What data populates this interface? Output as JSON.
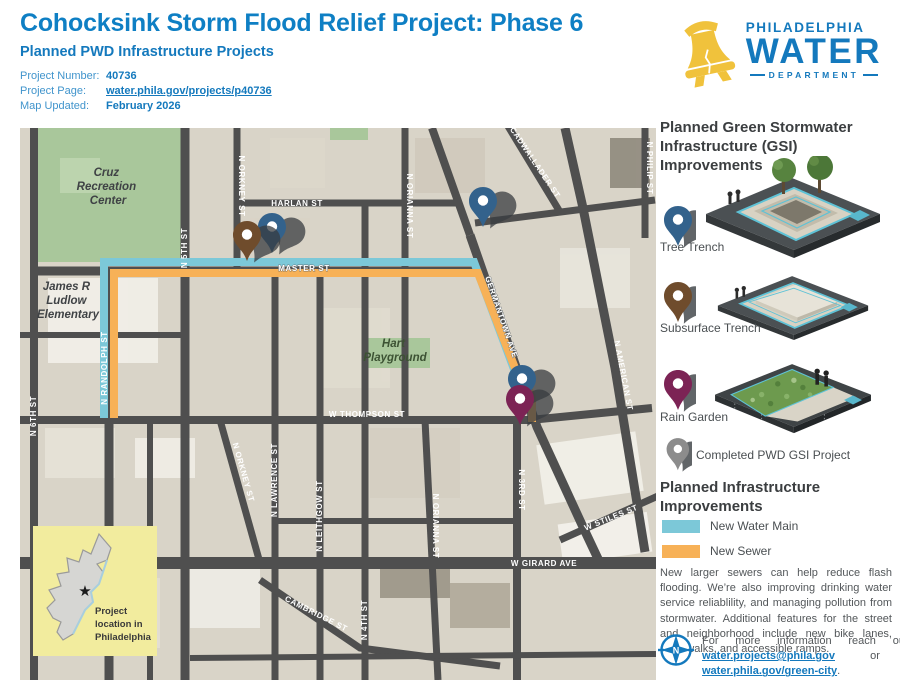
{
  "header": {
    "title": "Cohocksink Storm Flood Relief Project: Phase 6",
    "subtitle": "Planned PWD Infrastructure Projects",
    "info": {
      "project_number_label": "Project Number:",
      "project_number": "40736",
      "project_page_label": "Project Page:",
      "project_page": "water.phila.gov/projects/p40736",
      "map_updated_label": "Map Updated:",
      "map_updated": "February 2026"
    }
  },
  "logo": {
    "line1": "PHILADELPHIA",
    "line2": "WATER",
    "line3": "DEPARTMENT"
  },
  "colors": {
    "pwd_blue": "#1479bd",
    "title_blue": "#0e7fc4",
    "water_main": "#7cc8d8",
    "sewer": "#f7b157",
    "tree_trench_pin": "#33628c",
    "subsurface_pin": "#6f4c2c",
    "rain_garden_pin": "#7c2355",
    "completed_pin": "#8c8c8c",
    "bell_yellow": "#f0c23c"
  },
  "sidebar": {
    "gsi_heading": "Planned Green Stormwater Infrastructure (GSI) Improvements",
    "tree_trench_label": "Tree Trench",
    "subsurface_label": "Subsurface Trench",
    "rain_garden_label": "Rain Garden",
    "completed_label": "Completed PWD GSI Project",
    "infra_heading": "Planned Infrastructure Improvements",
    "water_main_label": "New Water Main",
    "sewer_label": "New Sewer",
    "body_text": "New larger sewers can help reduce flash flooding. We’re also improving drinking water service reliablility, and managing pollution from stormwater. Additional features for the street and neighborhood include new bike lanes, crosswalks, and accessible ramps.",
    "contact": {
      "prefix": "For more information reach out to",
      "email": "water.projects@phila.gov",
      "middle": "or visit",
      "site": "water.phila.gov/green-city",
      "suffix": "."
    }
  },
  "map": {
    "streets": {
      "n6th": "N 6TH ST",
      "n5th": "N 5TH ST",
      "randolph": "N RANDOLPH ST",
      "orkney": "N ORKNEY ST",
      "orkney2": "N ORKNEY ST",
      "lawrence": "N LAWRENCE ST",
      "leithgow": "N LEITHGOW ST",
      "n4th": "N 4TH ST",
      "orianna": "N ORIANNA ST",
      "orianna2": "N ORIANNA ST",
      "n3rd": "N 3RD ST",
      "american": "N AMERICAN ST",
      "philip": "N PHILIP ST",
      "cadwallader": "CADWALLADER ST",
      "germantown": "GERMANTOWN AVE",
      "harlan": "HARLAN ST",
      "master": "MASTER ST",
      "thompson": "W THOMPSON ST",
      "girard": "W GIRARD AVE",
      "cambridge": "CAMBRIDGE ST",
      "stiles": "W STILES ST"
    },
    "places": {
      "cruz_l1": "Cruz",
      "cruz_l2": "Recreation",
      "cruz_l3": "Center",
      "ludlow_l1": "James R",
      "ludlow_l2": "Ludlow",
      "ludlow_l3": "Elementary",
      "hart_l1": "Hart",
      "hart_l2": "Playground"
    },
    "inset": {
      "l1": "Project",
      "l2": "location in",
      "l3": "Philadelphia"
    }
  }
}
